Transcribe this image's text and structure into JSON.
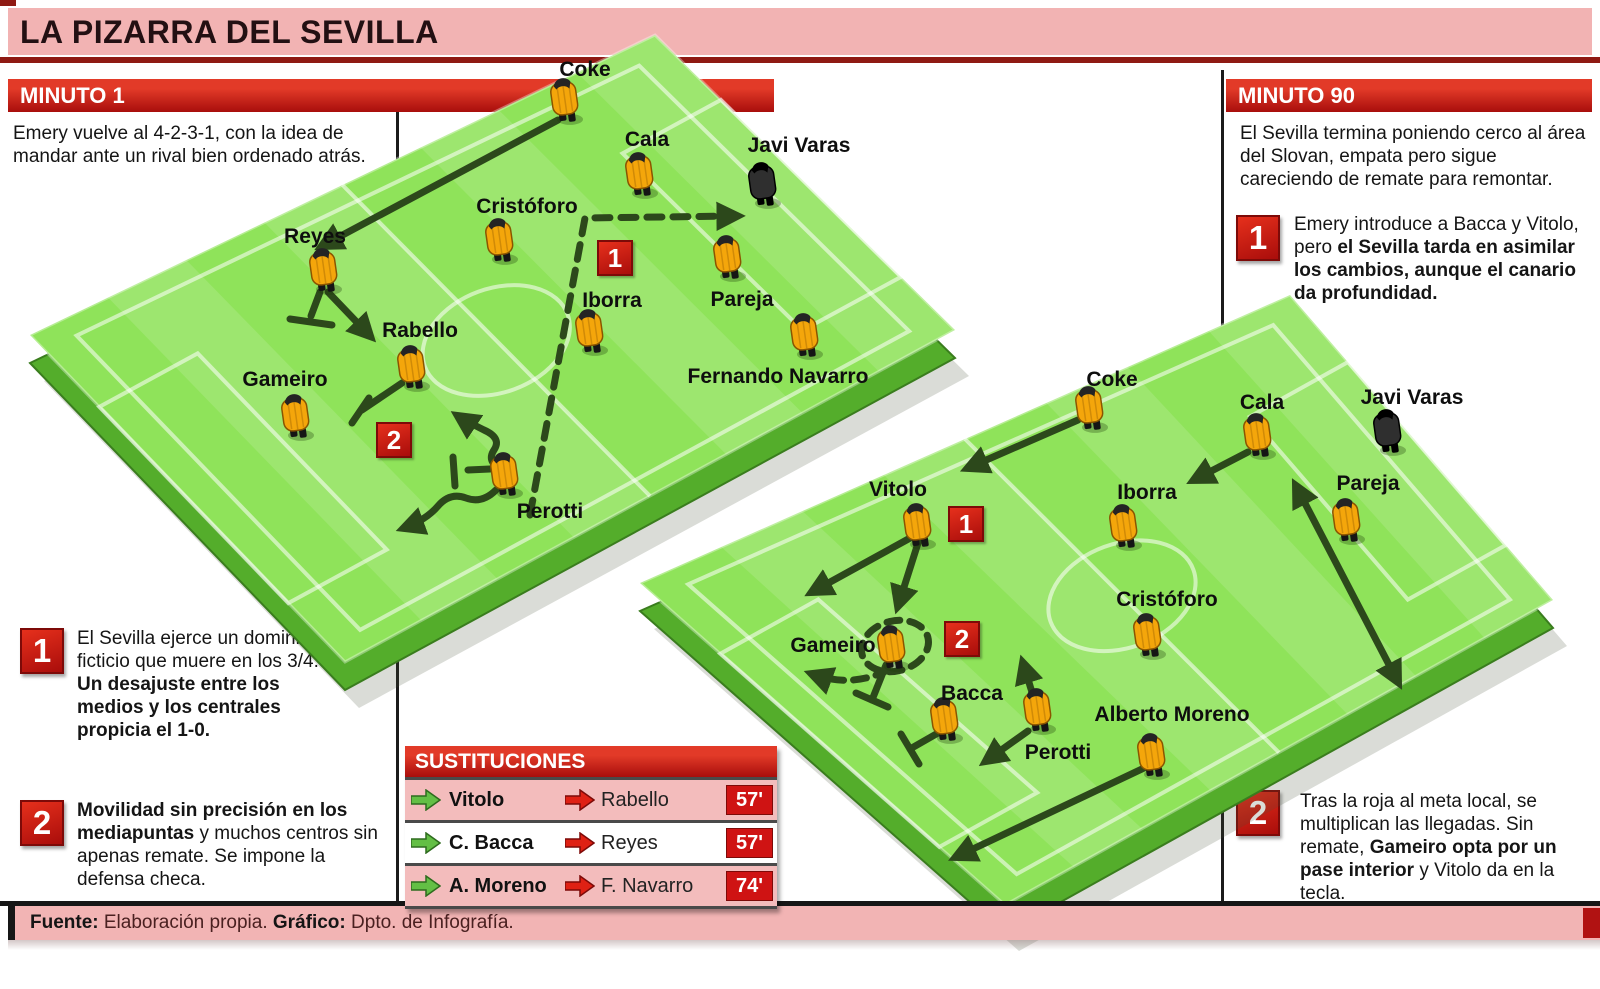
{
  "title": {
    "text": "LA PIZARRA DEL SEVILLA"
  },
  "panels": {
    "left": {
      "header": "MINUTO 1",
      "intro": "Emery vuelve al 4-2-3-1, con la idea de mandar ante un rival bien ordenado atrás.",
      "note1": {
        "num": "1",
        "part1": "El Sevilla ejerce un dominio ficticio que muere en los 3/4. ",
        "part2_bold": "Un desajuste entre los medios y los centrales propicia el 1-0."
      },
      "note2": {
        "num": "2",
        "part1_bold": "Movilidad sin precisión en los mediapuntas",
        "part2": " y muchos centros sin apenas remate. Se impone la defensa checa."
      }
    },
    "right": {
      "header": "MINUTO 90",
      "intro": "El Sevilla termina poniendo cerco al área del Slovan, empata pero sigue careciendo de remate para remontar.",
      "note1": {
        "num": "1",
        "part1": "Emery introduce a Bacca y Vitolo, pero ",
        "part2_bold": "el Sevilla tarda en asimilar los cambios, aunque el canario da profundidad."
      },
      "note2": {
        "num": "2",
        "part1": "Tras la roja al meta local, se multiplican las llegadas. Sin remate, ",
        "part2_bold": "Gameiro opta por un pase interior",
        "part3": " y Vitolo da en la tecla."
      }
    }
  },
  "pitch_minute1": {
    "badge1": "1",
    "badge2": "2",
    "players": {
      "coke": "Coke",
      "cala": "Cala",
      "javi_varas": "Javi Varas",
      "cristoforo": "Cristóforo",
      "reyes": "Reyes",
      "iborra": "Iborra",
      "pareja": "Pareja",
      "rabello": "Rabello",
      "fernando_navarro": "Fernando Navarro",
      "gameiro": "Gameiro",
      "perotti": "Perotti"
    }
  },
  "pitch_minute90": {
    "badge1": "1",
    "badge2": "2",
    "players": {
      "coke": "Coke",
      "cala": "Cala",
      "javi_varas": "Javi Varas",
      "vitolo": "Vitolo",
      "iborra": "Iborra",
      "pareja": "Pareja",
      "cristoforo": "Cristóforo",
      "gameiro": "Gameiro",
      "bacca": "Bacca",
      "perotti": "Perotti",
      "alberto_moreno": "Alberto Moreno"
    }
  },
  "substitutions": {
    "header": "SUSTITUCIONES",
    "rows": [
      {
        "in": "Vitolo",
        "out": "Rabello",
        "minute": "57'"
      },
      {
        "in": "C. Bacca",
        "out": "Reyes",
        "minute": "57'"
      },
      {
        "in": "A. Moreno",
        "out": "F. Navarro",
        "minute": "74'"
      }
    ]
  },
  "footer": {
    "source_label": "Fuente:",
    "source_text": " Elaboración propia. ",
    "credit_label": "Gráfico:",
    "credit_text": " Dpto. de Infografía."
  },
  "colors": {
    "accent_red": "#c41414",
    "banner_pink": "#f2b3b3",
    "pitch_green": "#8fe35a",
    "arrow_green": "#2c481b"
  }
}
